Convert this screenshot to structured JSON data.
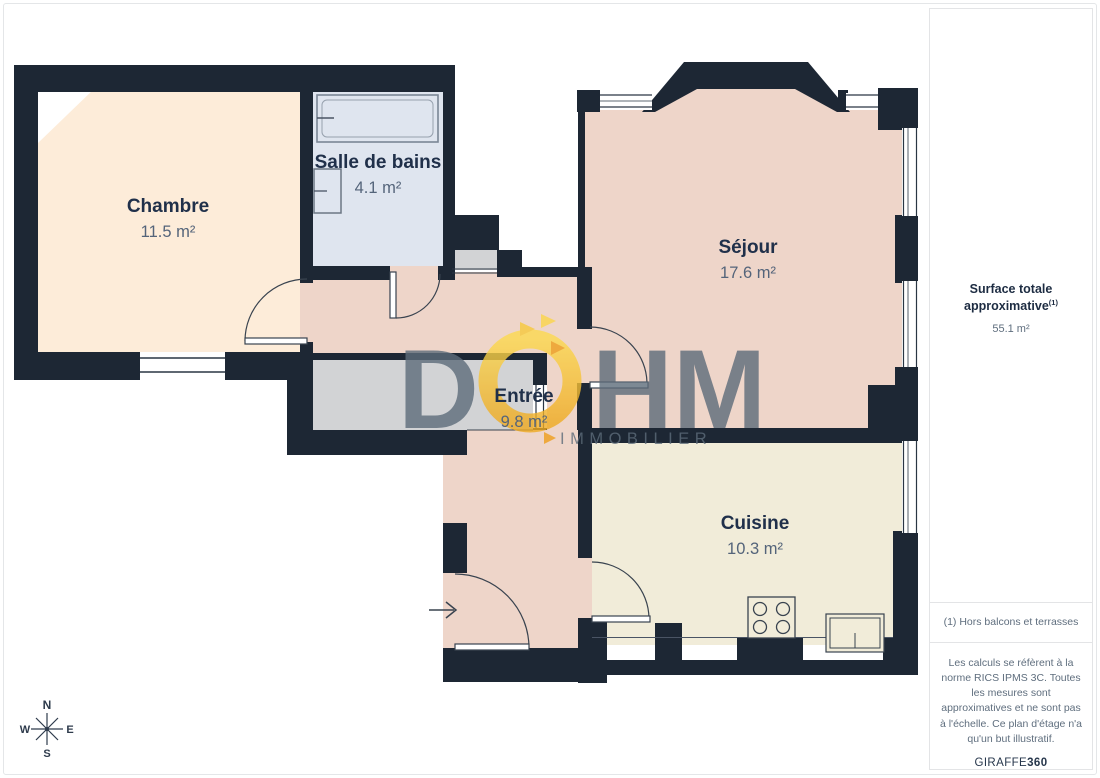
{
  "rooms": {
    "chambre": {
      "name": "Chambre",
      "area": "11.5 m²"
    },
    "salle_de_bains": {
      "name": "Salle de bains",
      "area": "4.1 m²"
    },
    "sejour": {
      "name": "Séjour",
      "area": "17.6 m²"
    },
    "entree": {
      "name": "Entrée",
      "area": "9.8 m²"
    },
    "cuisine": {
      "name": "Cuisine",
      "area": "10.3 m²"
    }
  },
  "sidebar": {
    "total_label": "Surface totale approximative",
    "total_sup": "(1)",
    "total_value": "55.1 m²",
    "footnote": "(1) Hors balcons et terrasses",
    "disclaimer": "Les calculs se réfèrent à la norme RICS IPMS 3C. Toutes les mesures sont approximatives et ne sont pas à l'échelle. Ce plan d'étage n'a qu'un but illustratif.",
    "brand": "GIRAFFE",
    "brand_suffix": "360"
  },
  "watermark": {
    "letter_d": "D",
    "letters_hm": "HM",
    "subtitle": "IMMOBILIER"
  },
  "compass": {
    "north": "N",
    "south": "S",
    "east": "E",
    "west": "W"
  },
  "colors": {
    "wall": "#1d2734",
    "floor_bedroom": "#fdecd9",
    "floor_bath": "#dfe5ef",
    "floor_living": "#eed5c9",
    "floor_kitchen": "#f1ecd9",
    "floor_closet": "#d2d3d5",
    "accent_yellow": "#f8c937",
    "accent_amber": "#ef9f1c",
    "watermark_gray": "#5d6c7a"
  }
}
